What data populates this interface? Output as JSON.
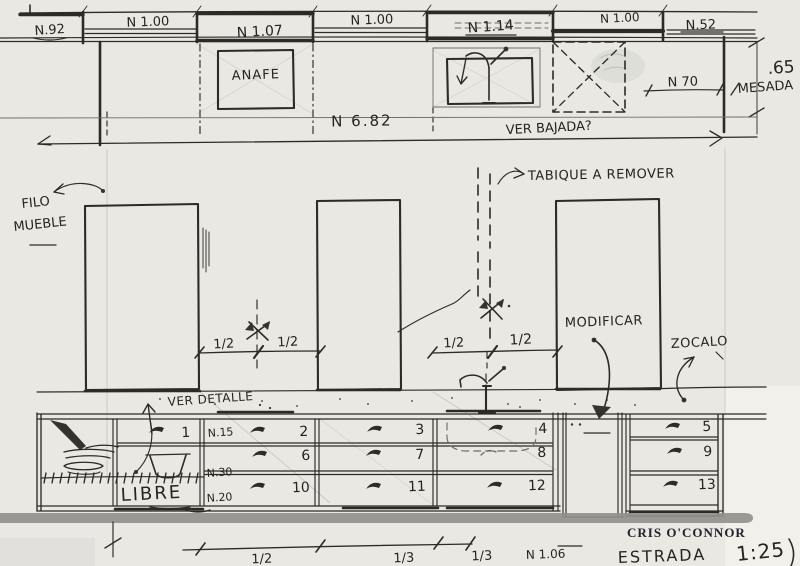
{
  "colors": {
    "paper": "#e9e8e3",
    "ink": "#2c2b26",
    "pencil": "#b3b2ab",
    "marker_bar": "#908f8b"
  },
  "top_labels": [
    "N.92",
    "N 1.00",
    "N 1.07",
    "N 1.00",
    "N 1.14",
    "N 1.00",
    "N.52"
  ],
  "anafe": "ANAFE",
  "dims": {
    "total": "N 6.82",
    "ver_bajada": "VER BAJADA?",
    "n70": "N 70",
    "height": ".65",
    "mesada": "MESADA",
    "halves": [
      "1/2",
      "1/2",
      "1/2",
      "1/2"
    ],
    "bottom": [
      "1/2",
      "1/3",
      "1/3",
      "N 1.06"
    ]
  },
  "notes": {
    "filo1": "FILO",
    "filo2": "MUEBLE",
    "tabique": "TABIQUE A REMOVER",
    "modificar": "MODIFICAR",
    "zocalo": "ZOCALO",
    "ver_detalle": "VER DETALLE",
    "libre": "LIBRE"
  },
  "drawers": [
    "1",
    "2",
    "3",
    "4",
    "5",
    "6",
    "7",
    "8",
    "9",
    "10",
    "11",
    "12",
    "13"
  ],
  "depths": [
    "N.15",
    "N.30",
    "N.20"
  ],
  "footer": {
    "stamp": "CRIS O'CONNOR",
    "name": "ESTRADA",
    "scale": "1:25"
  }
}
